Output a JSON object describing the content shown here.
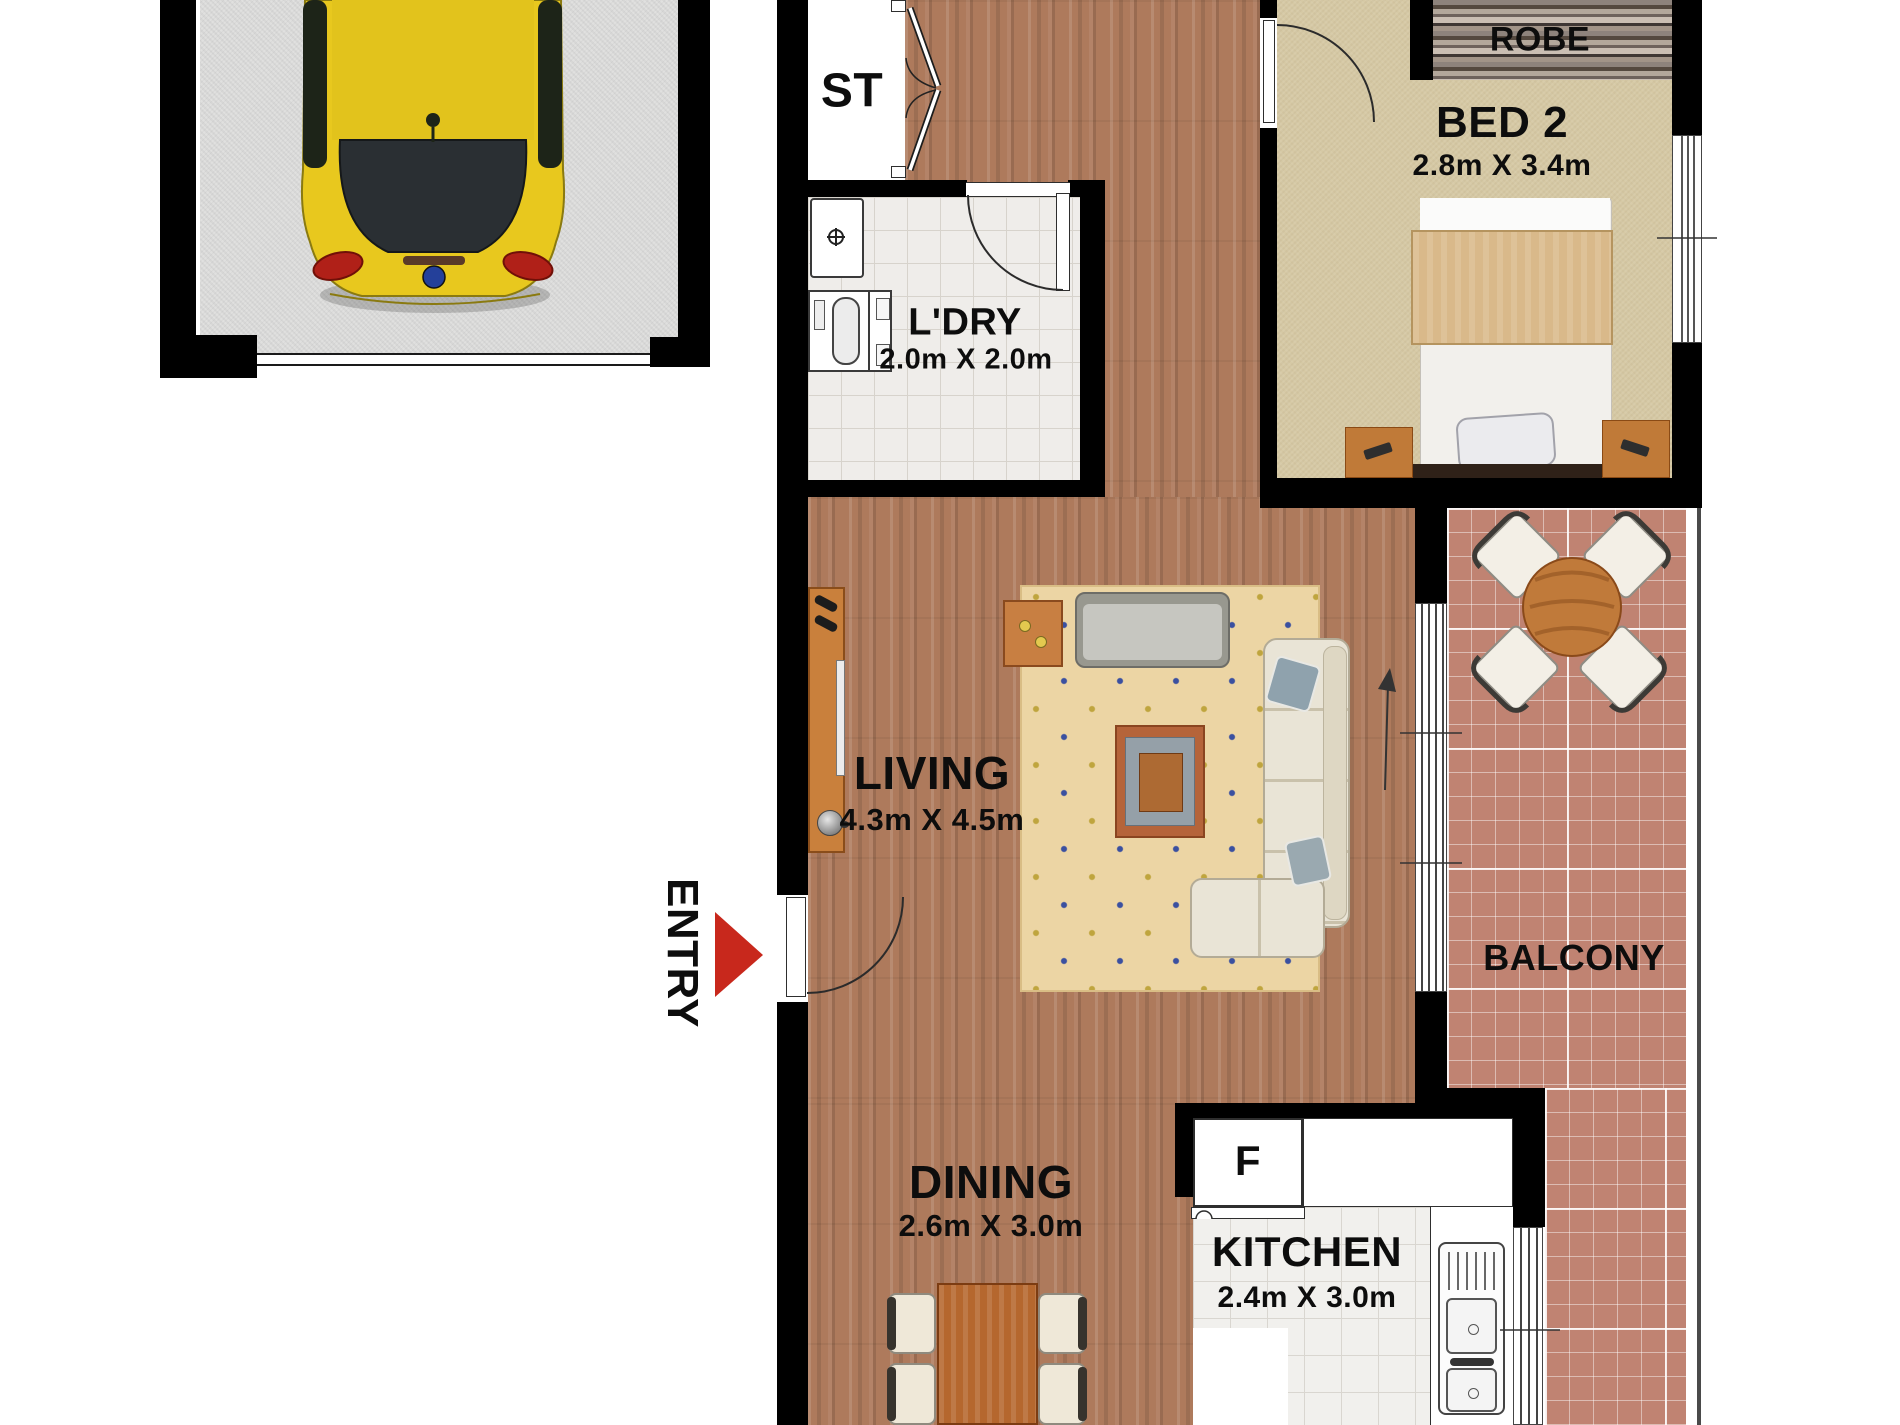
{
  "plan": {
    "rooms": {
      "storage": {
        "label": "ST"
      },
      "laundry": {
        "label": "L'DRY",
        "dims": "2.0m X 2.0m"
      },
      "robe": {
        "label": "ROBE"
      },
      "bed2": {
        "label": "BED 2",
        "dims": "2.8m X 3.4m"
      },
      "living": {
        "label": "LIVING",
        "dims": "4.3m X 4.5m"
      },
      "balcony": {
        "label": "BALCONY"
      },
      "dining": {
        "label": "DINING",
        "dims": "2.6m X 3.0m"
      },
      "kitchen": {
        "label": "KITCHEN",
        "dims": "2.4m X 3.0m"
      }
    },
    "entry": {
      "label": "ENTRY"
    },
    "appliances": {
      "fridge_label": "F"
    },
    "colors": {
      "wall": "#000000",
      "wood_floor": "#ae7a5c",
      "laundry_tile": "#efedea",
      "kitchen_tile": "#f1f0ed",
      "balcony_tile": "#c08372",
      "bedroom_carpet": "#d6c9a5",
      "rug": "#ecd5a4",
      "entry_arrow": "#c8281c",
      "car_body": "#e8c81e"
    }
  }
}
